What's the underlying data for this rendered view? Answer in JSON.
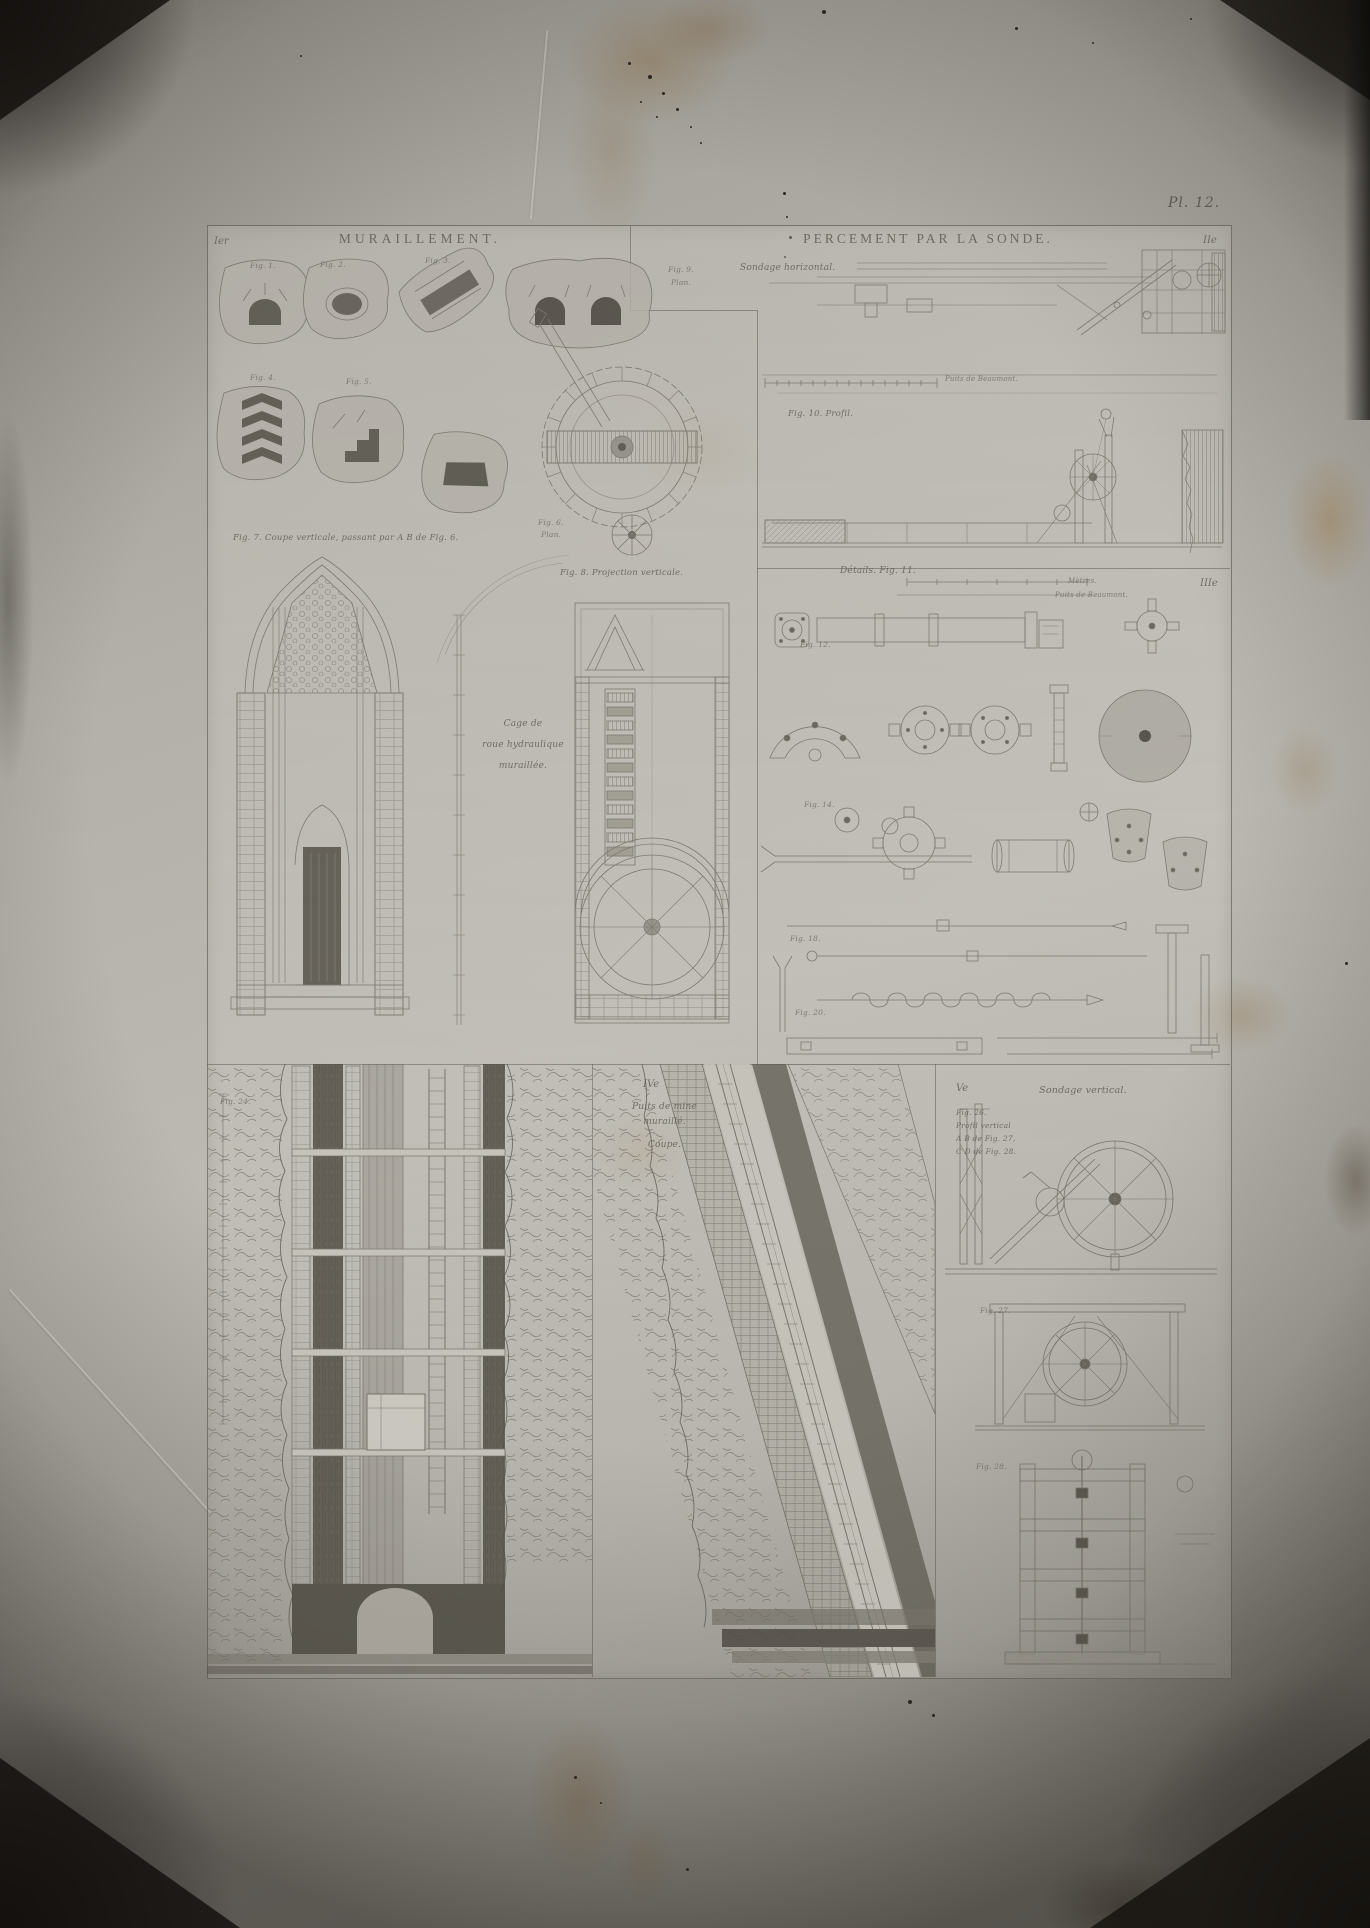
{
  "photo": {
    "plate_number": "Pl. 12.",
    "colors": {
      "paper": "#b3b0a9",
      "ink": "#6d6960",
      "dark_ink": "#4c4840",
      "stain": "#856a3e",
      "shadow": "#17130f"
    }
  },
  "plate": {
    "sections": {
      "muraillement": {
        "header": "MURAILLEMENT.",
        "corner_mark": "Ier"
      },
      "percement": {
        "header": "PERCEMENT PAR LA SONDE.",
        "corner_mark": "IIe"
      },
      "details": {
        "corner_mark": "IIIe",
        "caption": "Détails. Fig. 11."
      },
      "puits": {
        "corner_mark": "IVe",
        "caption_line1": "Puits de mine",
        "caption_line2": "muraillé.",
        "caption_line3": "Coupe."
      },
      "sondage_vertical": {
        "corner_mark": "Ve",
        "header": "Sondage vertical."
      }
    },
    "captions": {
      "fig1": "Fig. 1.",
      "fig2": "Fig. 2.",
      "fig3": "Fig. 3.",
      "fig4": "Fig. 4.",
      "fig5": "Fig. 5.",
      "fig6": "Fig. 6.",
      "fig6_sub": "Plan.",
      "fig7": "Fig. 7. Coupe verticale, passant par A B de Fig. 6.",
      "fig8": "Fig. 8. Projection verticale.",
      "cage_1": "Cage de",
      "cage_2": "roue hydraulique",
      "cage_3": "muraillée.",
      "fig9": "Fig. 9.",
      "fig9_sub": "Plan.",
      "sondage_horizontal": "Sondage horizontal.",
      "scale_plan": "Puits de Beaumont.",
      "fig10": "Fig. 10. Profil.",
      "details_scale1": "Mètres.",
      "details_scale2": "Puits de Beaumont.",
      "fig12": "Fig. 12.",
      "fig14": "Fig. 14.",
      "fig18": "Fig. 18.",
      "fig20": "Fig. 20.",
      "fig24": "Fig. 24.",
      "fig26_1": "Fig. 26.",
      "fig26_2": "Profil vertical",
      "fig26_3": "A B de Fig. 27,",
      "fig26_4": "C D de Fig. 28.",
      "fig27": "Fig. 27.",
      "fig28": "Fig. 28."
    }
  }
}
